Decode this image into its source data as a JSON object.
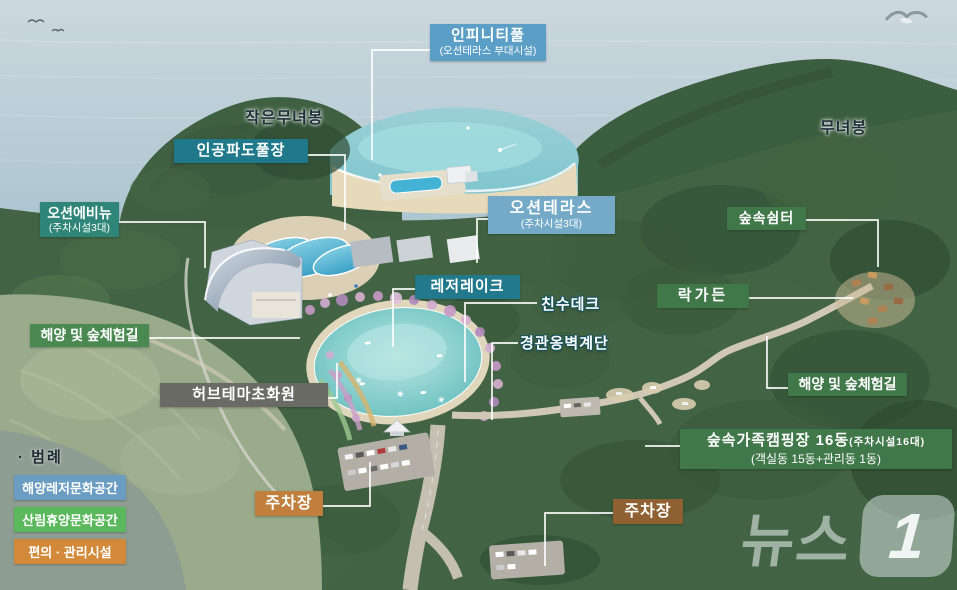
{
  "watermark": {
    "text": "뉴스",
    "badge": "1"
  },
  "peaks": {
    "small_peak": "작은무녀봉",
    "main_peak": "무녀봉"
  },
  "callouts": {
    "infinity_pool": {
      "title": "인피니티풀",
      "subtitle": "(오션테라스 부대시설)",
      "color": "#5b9ec6"
    },
    "wave_pool": {
      "title": "인공파도풀장",
      "color": "#20798b"
    },
    "ocean_avenue": {
      "title": "오션에비뉴",
      "subtitle": "(주차시설3대)",
      "color": "#2e8578"
    },
    "ocean_terrace": {
      "title": "오션테라스",
      "subtitle": "(주차시설3대)",
      "color": "#74aac8"
    },
    "leisure_lake": {
      "title": "레저레이크",
      "color": "#21798b"
    },
    "waterside_deck": {
      "title": "친수데크"
    },
    "retaining_wall_stairs": {
      "title": "경관옹벽계단"
    },
    "forest_shelter": {
      "title": "숲속쉼터",
      "color": "#41784a"
    },
    "rock_garden": {
      "title": "락가든",
      "color": "#41784a"
    },
    "sea_forest_trail_right": {
      "title": "해양 및 숲체험길",
      "color": "#41784a"
    },
    "sea_forest_trail_left": {
      "title": "해양 및 숲체험길",
      "color": "#4a8a52"
    },
    "herb_garden": {
      "title": "허브테마초화원",
      "color": "#6b6b66"
    },
    "family_camping": {
      "title": "숲속가족캠핑장 16동",
      "title_note": "(주차시설16대)",
      "subtitle": "(객실동 15동+관리동 1동)",
      "color": "#41784a"
    },
    "parking_left": {
      "title": "주차장",
      "color": "#c07f3d"
    },
    "parking_right": {
      "title": "주차장",
      "color": "#8f6132"
    }
  },
  "legend": {
    "title": "· 범례",
    "items": [
      {
        "label": "해양레저문화공간",
        "color": "#6b9dc2"
      },
      {
        "label": "산림휴양문화공간",
        "color": "#5cb85c"
      },
      {
        "label": "편의 · 관리시설",
        "color": "#d2893a"
      }
    ]
  }
}
